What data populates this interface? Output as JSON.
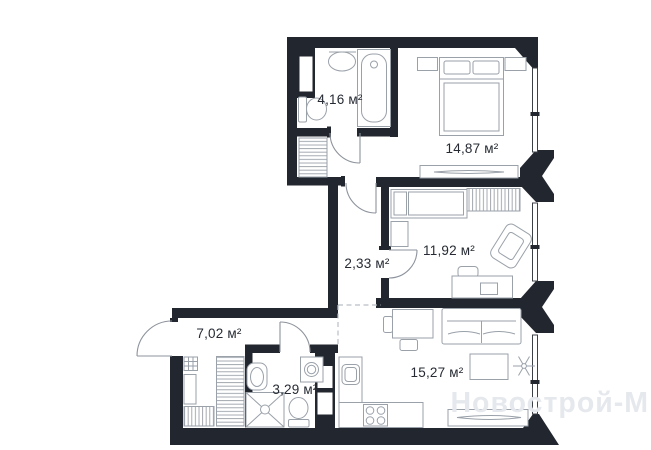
{
  "plan": {
    "background": "#ffffff",
    "wall_color": "#22262e",
    "furniture_color": "#9aa1a9",
    "label_color": "#262b33",
    "dashed_line_color": "#b9bec5",
    "watermark": {
      "text": "Новострой-М",
      "color": "#e5e8ec"
    },
    "rooms": [
      {
        "name": "bathroom-top",
        "area_label": "4,16 м²"
      },
      {
        "name": "bedroom",
        "area_label": "14,87 м²"
      },
      {
        "name": "room",
        "area_label": "11,92 м²"
      },
      {
        "name": "hallway",
        "area_label": "2,33 м²"
      },
      {
        "name": "corridor",
        "area_label": "7,02 м²"
      },
      {
        "name": "shower-room",
        "area_label": "3,29 м²"
      },
      {
        "name": "kitchen-living",
        "area_label": "15,27 м²"
      }
    ]
  }
}
